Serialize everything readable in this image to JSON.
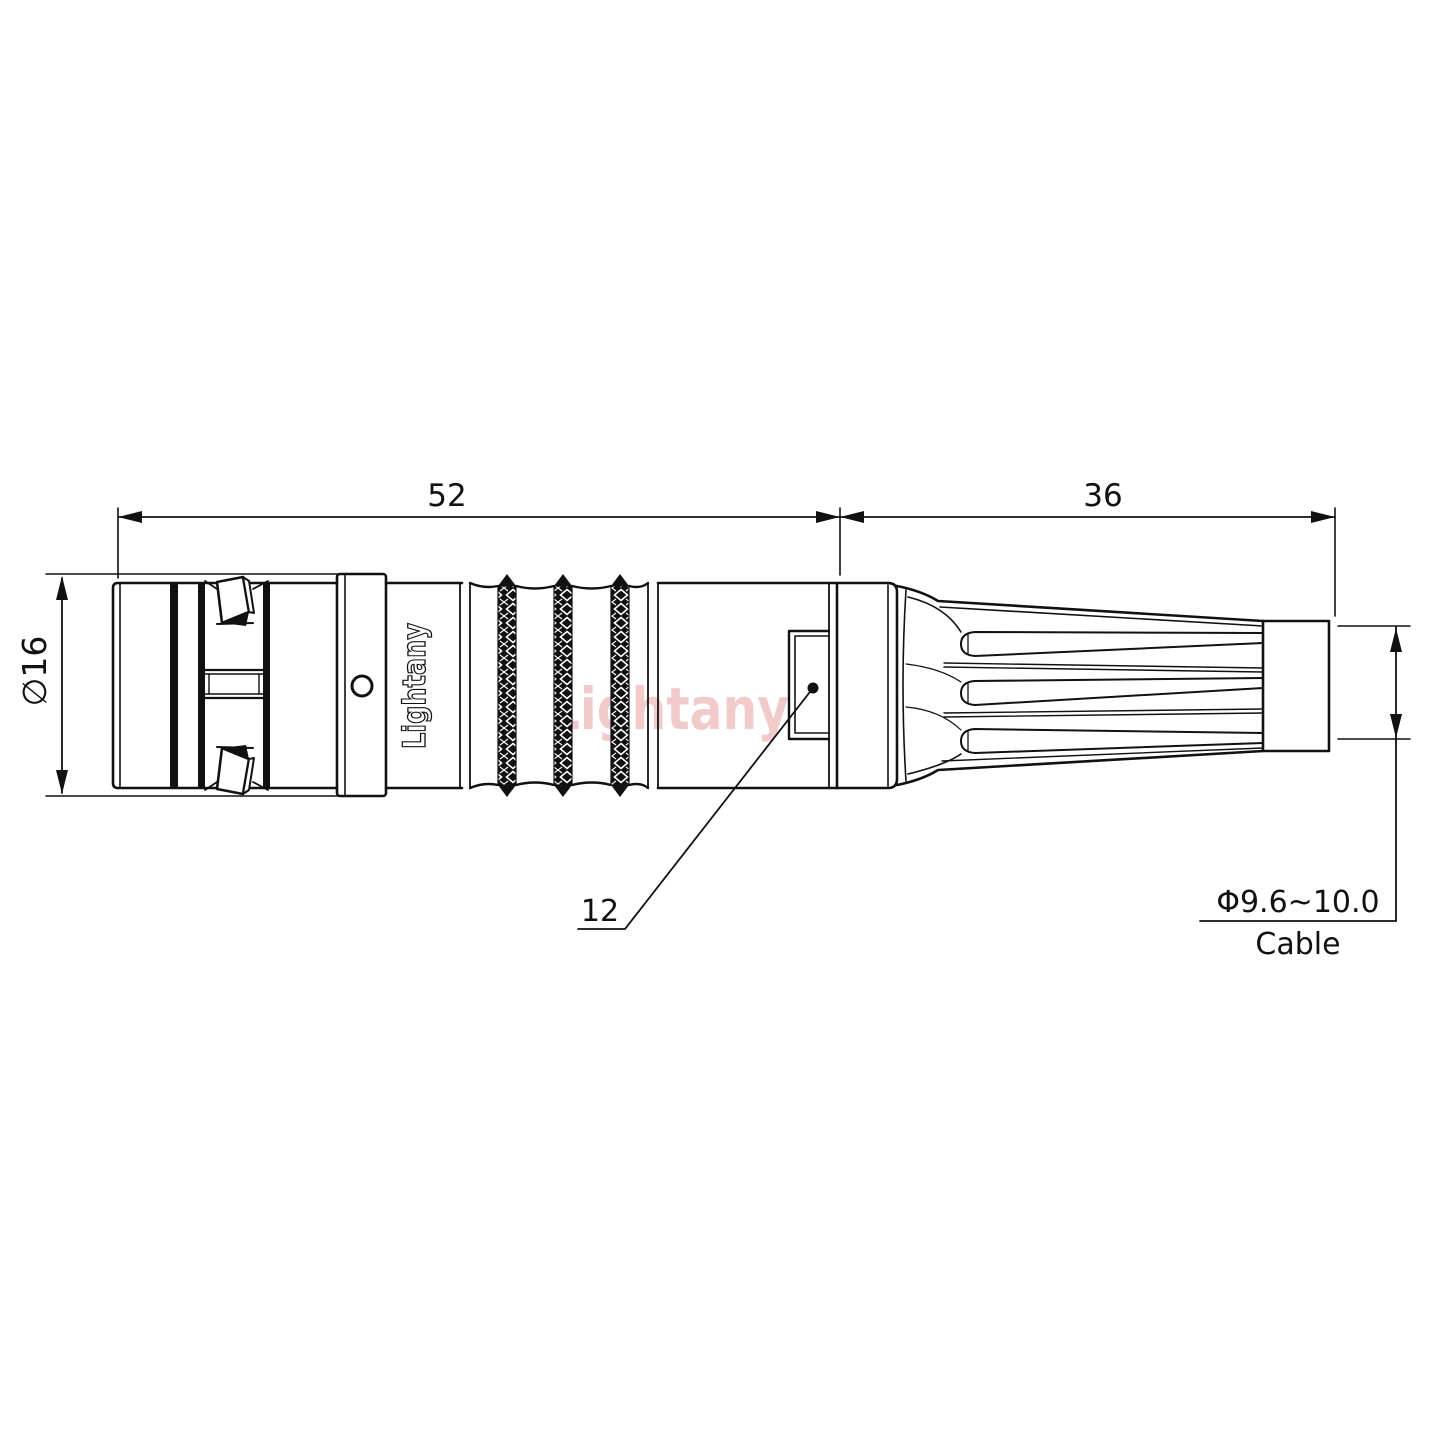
{
  "drawing": {
    "dimensions": {
      "body_length": "52",
      "relief_length": "36",
      "body_diameter": "∅16",
      "window_size": "12",
      "cable_diameter": "Φ9.6~10.0",
      "cable_label": "Cable"
    },
    "branding": {
      "body_marking": "Lightany",
      "watermark": "Lightany"
    },
    "colors": {
      "line": "#111111",
      "watermark": "#e79f9f",
      "background": "#ffffff"
    }
  }
}
